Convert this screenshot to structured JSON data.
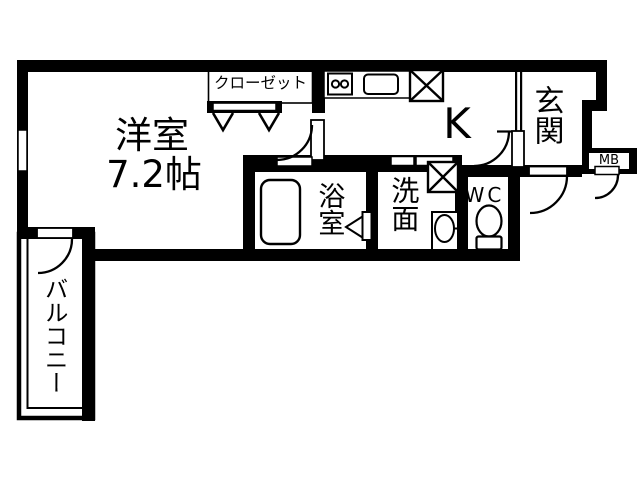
{
  "plan": {
    "type": "apartment-floor-plan",
    "colors": {
      "wall": "#000000",
      "floor": "#ffffff",
      "line": "#000000"
    },
    "labels": {
      "room": "洋室",
      "room_size": "7.2帖",
      "closet": "クローゼット",
      "kitchen": "K",
      "entrance": "玄関",
      "meter_box": "MB",
      "bath": "浴室",
      "wash": "洗面",
      "wc": "WC",
      "balcony": "バルコニー"
    },
    "fixtures": [
      "stove-icon",
      "sink-icon",
      "refrigerator-space-icon",
      "bathtub-icon",
      "washing-machine-space-icon",
      "wash-basin-icon",
      "toilet-icon",
      "closet-hanger-icon",
      "window",
      "door-swing-arc",
      "meter-box",
      "balcony-railing"
    ]
  }
}
